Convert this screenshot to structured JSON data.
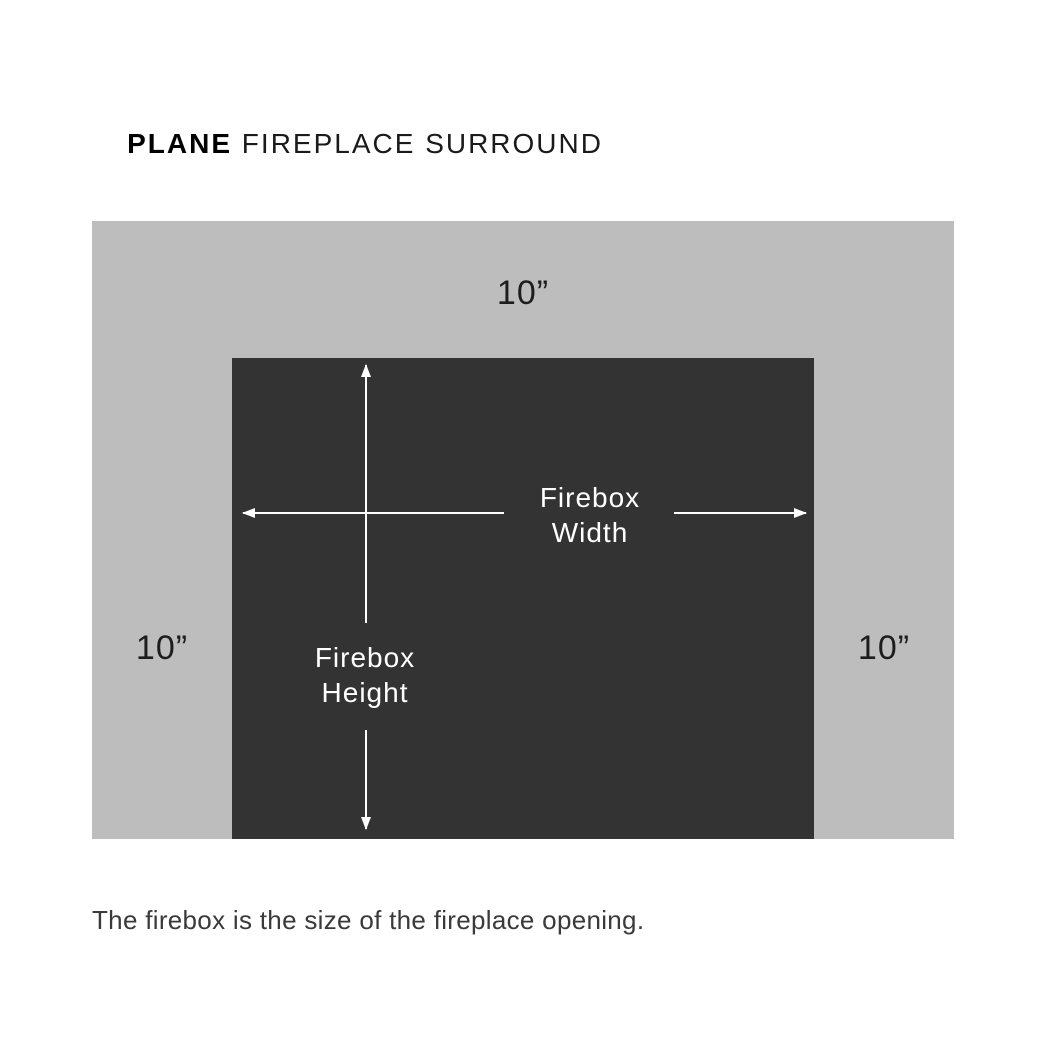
{
  "title": {
    "brand": "PLANE",
    "rest": " FIREPLACE SURROUND"
  },
  "diagram": {
    "surround_color": "#bdbdbd",
    "firebox_color": "#333333",
    "arrow_color": "#ffffff",
    "top_margin_label": "10”",
    "left_margin_label": "10”",
    "right_margin_label": "10”",
    "width_label": {
      "line1": "Firebox",
      "line2": "Width"
    },
    "height_label": {
      "line1": "Firebox",
      "line2": "Height"
    }
  },
  "caption": "The firebox is the size of the fireplace opening."
}
